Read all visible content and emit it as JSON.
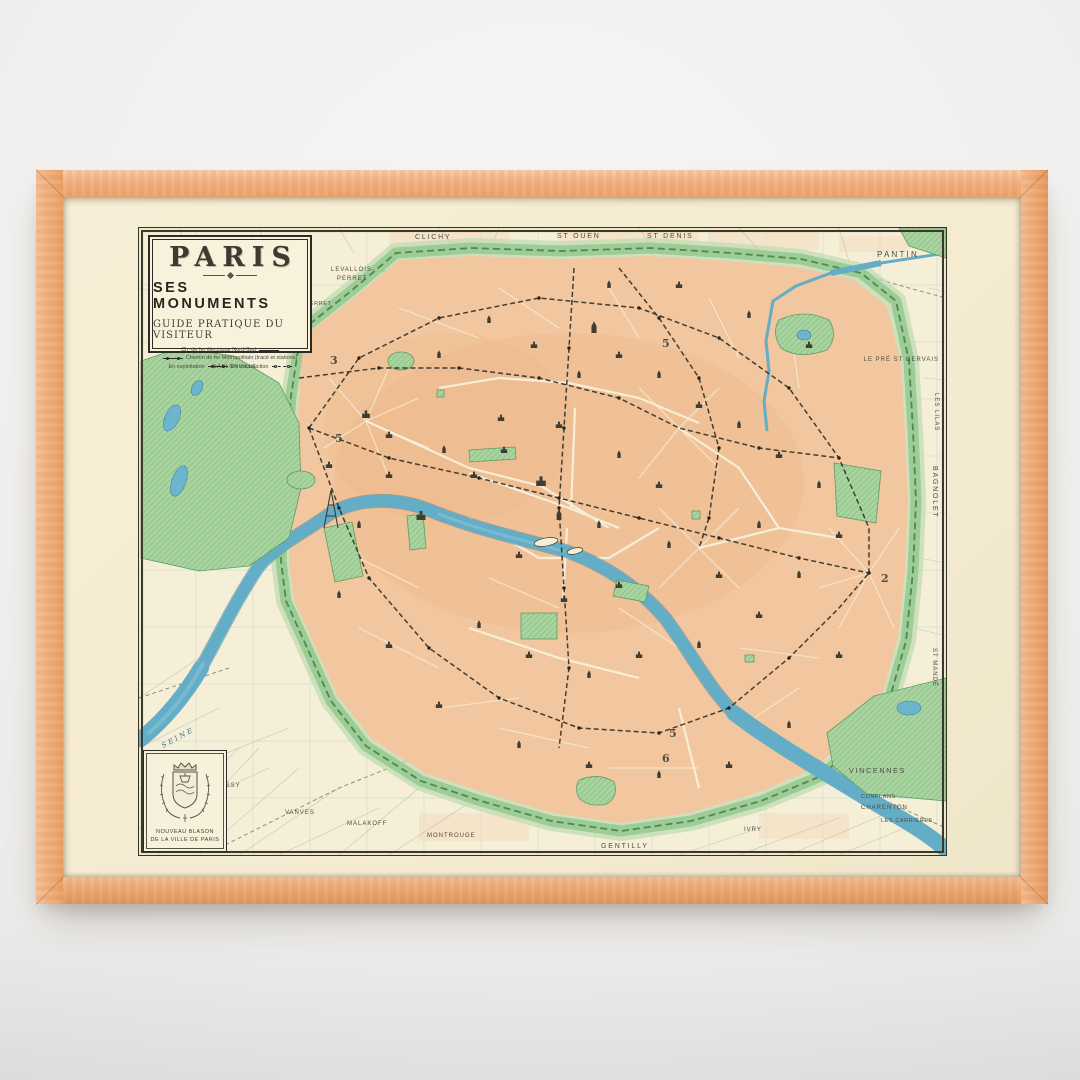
{
  "artwork": {
    "type": "framed vintage map poster",
    "cartouche": {
      "title": "PARIS",
      "subtitle": "SES MONUMENTS",
      "tagline": "GUIDE PRATIQUE DU VISITEUR",
      "legend_electric": "Ch. de fer électrique Nord-Sud",
      "legend_metro": "Chemin de fer Métropolitain (tracé et stations)",
      "legend_exploitation": "En exploitation",
      "legend_construction": "En construction"
    },
    "crest": {
      "caption_line1": "NOUVEAU BLASON",
      "caption_line2": "DE LA VILLE DE PARIS"
    },
    "labels": {
      "clichy": "CLICHY",
      "st_ouen": "ST OUEN",
      "st_denis": "ST DENIS",
      "pantin": "PANTIN",
      "le_pre_st_gervais": "LE PRÉ ST GERVAIS",
      "les_lilas": "LES LILAS",
      "bagnolet": "BAGNOLET",
      "st_mande": "ST MANDÉ",
      "vincennes": "VINCENNES",
      "conflans": "CONFLANS",
      "charenton": "CHARENTON",
      "les_carrieres": "LES CARRIÈRES",
      "ivry": "IVRY",
      "gentilly": "GENTILLY",
      "montrouge": "MONTROUGE",
      "malakoff": "MALAKOFF",
      "vanves": "VANVES",
      "issy": "ISSY",
      "seine": "SEINE",
      "sablonville": "SABLONVILLE",
      "levallois_line1": "LEVALLOIS-",
      "levallois_line2": "PERRET",
      "champerret": "CHAMPERRET"
    },
    "line_numbers": {
      "n3": "3",
      "n5_north": "5",
      "n5_west": "5",
      "n5_south": "5",
      "n6": "6",
      "n2": "2"
    },
    "colors": {
      "wall": "#f1f0ee",
      "frame_wood": "#efae7b",
      "mat_paper": "#f4ebd1",
      "map_paper": "#f6efd8",
      "city_blocks": "#f2c79f",
      "parks": "#a9d4a0",
      "fortification_band": "#9dcc96",
      "water": "#63adc6",
      "ink": "#3c3c32"
    }
  }
}
